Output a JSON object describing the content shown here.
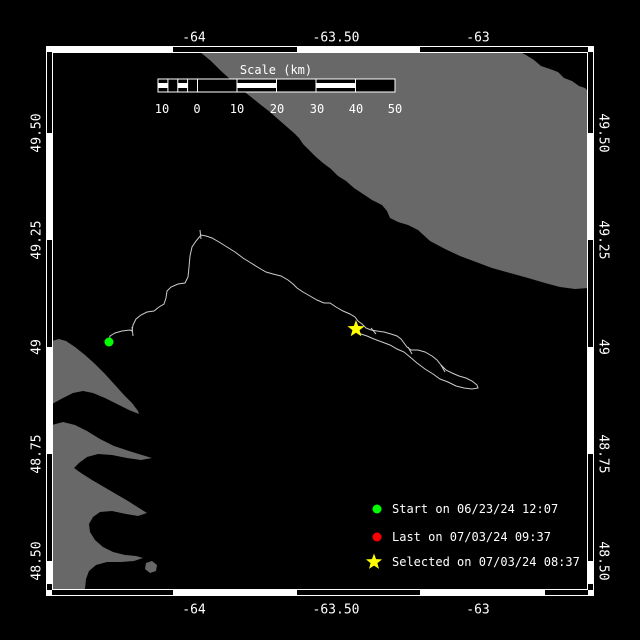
{
  "colors": {
    "background": "#000000",
    "land": "#686868",
    "track": "#cccccc",
    "frame": "#ffffff",
    "text": "#ffffff",
    "start_marker": "#00ff00",
    "last_marker": "#ff0000",
    "selected_marker": "#ffff00"
  },
  "axes": {
    "top": {
      "y": 38,
      "labels": [
        {
          "text": "-64",
          "x": 194
        },
        {
          "text": "-63.50",
          "x": 336
        },
        {
          "text": "-63",
          "x": 478
        }
      ]
    },
    "bottom": {
      "y": 610,
      "labels": [
        {
          "text": "-64",
          "x": 194
        },
        {
          "text": "-63.50",
          "x": 336
        },
        {
          "text": "-63",
          "x": 478
        }
      ]
    },
    "left": {
      "x": 37,
      "labels": [
        {
          "text": "49.50",
          "y": 133
        },
        {
          "text": "49.25",
          "y": 240
        },
        {
          "text": "49",
          "y": 347
        },
        {
          "text": "48.75",
          "y": 454
        },
        {
          "text": "48.50",
          "y": 561
        }
      ]
    },
    "right": {
      "x": 603,
      "labels": [
        {
          "text": "49.50",
          "y": 133
        },
        {
          "text": "49.25",
          "y": 240
        },
        {
          "text": "49",
          "y": 347
        },
        {
          "text": "48.75",
          "y": 454
        },
        {
          "text": "48.50",
          "y": 561
        }
      ]
    }
  },
  "scalebar": {
    "title": "Scale (km)",
    "title_x": 276,
    "title_y": 70,
    "bar": {
      "x": 158,
      "y": 79,
      "w": 237,
      "h": 13
    },
    "divisions": [
      158,
      197.5,
      237,
      276.5,
      316,
      355.5,
      395
    ],
    "subdivisions": [
      167.9,
      177.8,
      187.6
    ],
    "striped_cells": [
      [
        158,
        167.9
      ],
      [
        177.8,
        187.6
      ],
      [
        237,
        276.5
      ],
      [
        316,
        355.5
      ]
    ],
    "numbers": [
      {
        "text": "10",
        "x": 162
      },
      {
        "text": "0",
        "x": 197
      },
      {
        "text": "10",
        "x": 237
      },
      {
        "text": "20",
        "x": 277
      },
      {
        "text": "30",
        "x": 317
      },
      {
        "text": "40",
        "x": 356
      },
      {
        "text": "50",
        "x": 395
      }
    ],
    "numbers_y": 109
  },
  "legend": {
    "marker_x": 377,
    "text_x": 392,
    "rows": [
      {
        "marker": "circle",
        "color": "#00ff00",
        "label": "Start on 06/23/24 12:07",
        "y": 509
      },
      {
        "marker": "circle",
        "color": "#ff0000",
        "label": "Last on 07/03/24 09:37",
        "y": 537
      },
      {
        "marker": "star",
        "color": "#ffff00",
        "label": "Selected on 07/03/24 08:37",
        "y": 562
      }
    ]
  },
  "frame": {
    "outer": [
      46,
      46,
      594,
      596
    ],
    "inner": [
      52,
      52,
      588,
      590
    ],
    "top_white": [
      [
        52,
        173
      ],
      [
        297,
        420
      ]
    ],
    "bottom_white": [
      [
        173,
        297
      ],
      [
        420,
        545
      ]
    ],
    "left_white": [
      [
        133,
        240
      ],
      [
        347,
        454
      ],
      [
        561,
        584
      ]
    ],
    "right_white": [
      [
        133,
        240
      ],
      [
        347,
        454
      ],
      [
        561,
        584
      ]
    ]
  },
  "land": [
    {
      "name": "land-anticosti",
      "points": [
        [
          200,
          52
        ],
        [
          520,
          52
        ],
        [
          526,
          55
        ],
        [
          534,
          60
        ],
        [
          541,
          66
        ],
        [
          550,
          69
        ],
        [
          558,
          72
        ],
        [
          564,
          78
        ],
        [
          572,
          81
        ],
        [
          579,
          86
        ],
        [
          585,
          88
        ],
        [
          588,
          91
        ],
        [
          588,
          288
        ],
        [
          575,
          289
        ],
        [
          560,
          287
        ],
        [
          545,
          283
        ],
        [
          528,
          278
        ],
        [
          510,
          273
        ],
        [
          492,
          268
        ],
        [
          476,
          262
        ],
        [
          460,
          256
        ],
        [
          445,
          249
        ],
        [
          430,
          241
        ],
        [
          418,
          230
        ],
        [
          408,
          225
        ],
        [
          398,
          222
        ],
        [
          390,
          218
        ],
        [
          387,
          211
        ],
        [
          382,
          205
        ],
        [
          372,
          200
        ],
        [
          363,
          194
        ],
        [
          354,
          188
        ],
        [
          346,
          181
        ],
        [
          338,
          176
        ],
        [
          331,
          169
        ],
        [
          323,
          163
        ],
        [
          316,
          157
        ],
        [
          309,
          150
        ],
        [
          303,
          144
        ],
        [
          299,
          138
        ],
        [
          294,
          133
        ],
        [
          287,
          127
        ],
        [
          279,
          120
        ],
        [
          270,
          112
        ],
        [
          261,
          105
        ],
        [
          251,
          97
        ],
        [
          241,
          89
        ],
        [
          231,
          80
        ],
        [
          221,
          71
        ],
        [
          211,
          61
        ]
      ]
    },
    {
      "name": "land-gaspe-upper-peninsula",
      "points": [
        [
          52,
          341
        ],
        [
          59,
          339
        ],
        [
          66,
          341
        ],
        [
          75,
          347
        ],
        [
          85,
          355
        ],
        [
          95,
          364
        ],
        [
          105,
          374
        ],
        [
          115,
          385
        ],
        [
          124,
          395
        ],
        [
          132,
          403
        ],
        [
          138,
          411
        ],
        [
          139,
          414
        ],
        [
          129,
          410
        ],
        [
          117,
          404
        ],
        [
          105,
          398
        ],
        [
          93,
          393
        ],
        [
          83,
          391
        ],
        [
          73,
          393
        ],
        [
          63,
          398
        ],
        [
          52,
          404
        ]
      ]
    },
    {
      "name": "land-gaspe-main",
      "points": [
        [
          52,
          425
        ],
        [
          63,
          422
        ],
        [
          75,
          425
        ],
        [
          87,
          431
        ],
        [
          100,
          439
        ],
        [
          114,
          446
        ],
        [
          129,
          451
        ],
        [
          142,
          455
        ],
        [
          152,
          458
        ],
        [
          141,
          460
        ],
        [
          127,
          458
        ],
        [
          112,
          455
        ],
        [
          98,
          454
        ],
        [
          87,
          457
        ],
        [
          79,
          463
        ],
        [
          74,
          468
        ],
        [
          81,
          473
        ],
        [
          92,
          480
        ],
        [
          104,
          487
        ],
        [
          116,
          494
        ],
        [
          128,
          501
        ],
        [
          139,
          508
        ],
        [
          147,
          513
        ],
        [
          138,
          516
        ],
        [
          126,
          514
        ],
        [
          112,
          511
        ],
        [
          100,
          512
        ],
        [
          93,
          517
        ],
        [
          89,
          524
        ],
        [
          90,
          532
        ],
        [
          95,
          540
        ],
        [
          103,
          547
        ],
        [
          113,
          552
        ],
        [
          125,
          555
        ],
        [
          136,
          556
        ],
        [
          143,
          558
        ],
        [
          134,
          561
        ],
        [
          121,
          562
        ],
        [
          107,
          562
        ],
        [
          96,
          565
        ],
        [
          89,
          571
        ],
        [
          86,
          579
        ],
        [
          85,
          589
        ],
        [
          52,
          589
        ]
      ]
    },
    {
      "name": "land-small-island",
      "points": [
        [
          146,
          563
        ],
        [
          152,
          561
        ],
        [
          157,
          565
        ],
        [
          156,
          571
        ],
        [
          150,
          573
        ],
        [
          145,
          569
        ]
      ]
    }
  ],
  "track": {
    "points": [
      [
        109,
        342
      ],
      [
        110,
        336
      ],
      [
        115,
        333
      ],
      [
        122,
        331
      ],
      [
        130,
        330
      ],
      [
        132,
        331
      ],
      [
        133,
        325
      ],
      [
        136,
        319
      ],
      [
        141,
        315
      ],
      [
        147,
        312
      ],
      [
        154,
        311
      ],
      [
        159,
        307
      ],
      [
        164,
        304
      ],
      [
        166,
        298
      ],
      [
        167,
        291
      ],
      [
        171,
        287
      ],
      [
        178,
        284
      ],
      [
        185,
        283
      ],
      [
        188,
        277
      ],
      [
        189,
        267
      ],
      [
        190,
        256
      ],
      [
        192,
        247
      ],
      [
        196,
        241
      ],
      [
        201,
        235
      ],
      [
        206,
        236
      ],
      [
        212,
        238
      ],
      [
        219,
        242
      ],
      [
        227,
        247
      ],
      [
        235,
        252
      ],
      [
        243,
        258
      ],
      [
        251,
        263
      ],
      [
        259,
        268
      ],
      [
        266,
        272
      ],
      [
        273,
        274
      ],
      [
        281,
        276
      ],
      [
        288,
        280
      ],
      [
        293,
        284
      ],
      [
        297,
        288
      ],
      [
        303,
        292
      ],
      [
        310,
        296
      ],
      [
        317,
        300
      ],
      [
        324,
        303
      ],
      [
        330,
        303
      ],
      [
        336,
        307
      ],
      [
        343,
        311
      ],
      [
        350,
        314
      ],
      [
        355,
        317
      ],
      [
        358,
        321
      ],
      [
        362,
        324
      ],
      [
        366,
        328
      ],
      [
        371,
        330
      ],
      [
        377,
        331
      ],
      [
        384,
        332
      ],
      [
        391,
        334
      ],
      [
        397,
        336
      ],
      [
        401,
        339
      ],
      [
        404,
        343
      ],
      [
        407,
        347
      ],
      [
        411,
        350
      ],
      [
        418,
        350
      ],
      [
        425,
        352
      ],
      [
        432,
        356
      ],
      [
        437,
        360
      ],
      [
        441,
        365
      ],
      [
        446,
        370
      ],
      [
        452,
        373
      ],
      [
        459,
        376
      ],
      [
        466,
        378
      ],
      [
        472,
        381
      ],
      [
        477,
        385
      ],
      [
        478,
        388
      ],
      [
        472,
        389
      ],
      [
        464,
        388
      ],
      [
        456,
        386
      ],
      [
        448,
        382
      ],
      [
        440,
        379
      ],
      [
        433,
        374
      ],
      [
        425,
        369
      ],
      [
        417,
        363
      ],
      [
        410,
        357
      ],
      [
        404,
        352
      ],
      [
        397,
        349
      ],
      [
        390,
        345
      ],
      [
        382,
        342
      ],
      [
        374,
        339
      ],
      [
        367,
        336
      ],
      [
        361,
        334
      ],
      [
        357,
        332
      ]
    ],
    "direction_ticks": [
      [
        132,
        327,
        133,
        336
      ],
      [
        200,
        230,
        201,
        239
      ],
      [
        371,
        328,
        376,
        334
      ],
      [
        408,
        347,
        412,
        354
      ],
      [
        441,
        365,
        445,
        372
      ]
    ]
  },
  "markers": [
    {
      "name": "start-marker",
      "type": "circle",
      "x": 109,
      "y": 342,
      "r": 4.5,
      "color": "#00ff00"
    },
    {
      "name": "selected-marker",
      "type": "star",
      "x": 356,
      "y": 329,
      "r": 9,
      "color": "#ffff00"
    }
  ]
}
